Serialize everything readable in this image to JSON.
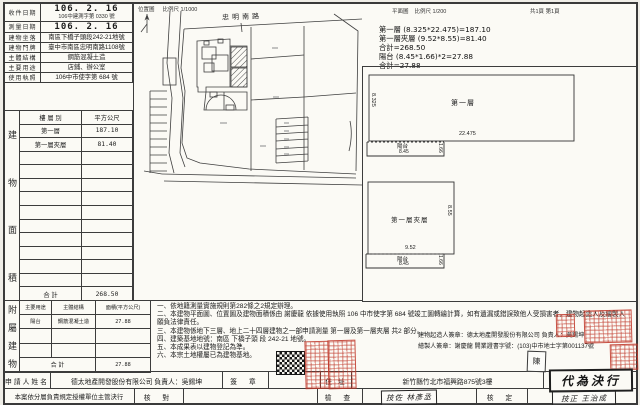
{
  "header": {
    "location_title": "位置圖",
    "location_scale": "比例尺 1/1000",
    "street": "忠明南路",
    "plan_title": "平面圖",
    "plan_scale": "比例尺 1/200",
    "pages": "共1頁 第1頁"
  },
  "info": {
    "rows": [
      {
        "label": "收件日期",
        "value": "106. 2. 16",
        "value2": "106中建測字第 0330 號"
      },
      {
        "label": "測量日期",
        "value": "106. 2. 16",
        "value2": ""
      },
      {
        "label": "建物坐落",
        "value": "南區下橋子頭段242-21地號",
        "value2": ""
      },
      {
        "label": "建物門牌",
        "value": "臺中市南區忠明南路1108號",
        "value2": ""
      },
      {
        "label": "主體結構",
        "value": "鋼筋混凝土造",
        "value2": ""
      },
      {
        "label": "主要用途",
        "value": "店鋪、辦公室",
        "value2": ""
      },
      {
        "label": "使用執照",
        "value": "106中市使字第 684 號",
        "value2": ""
      }
    ]
  },
  "area": {
    "vertical": [
      "建",
      "物",
      "面",
      "積"
    ],
    "col1": "樓 層 別",
    "col2": "平方公尺",
    "rows": [
      [
        "第一層",
        "187.10"
      ],
      [
        "第一層夾層",
        "81.40"
      ]
    ],
    "total_label": "合  計",
    "total_value": "268.50"
  },
  "annex": {
    "vertical": [
      "附",
      "屬",
      "建",
      "物"
    ],
    "col1": "主要用途",
    "col2": "主體結構",
    "col3": "面積(平方公尺)",
    "rows": [
      [
        "陽台",
        "鋼筋混凝土造",
        "27.88"
      ]
    ],
    "total_label": "合  計",
    "total_value": "27.88"
  },
  "calc": {
    "lines": [
      "第一層 (8.325*22.475)=187.10",
      "第一層夾層 (9.52*8.55)=81.40",
      "合計=268.50",
      "陽台 (8.45*1.66)*2=27.88",
      "合計=27.88"
    ]
  },
  "plan": {
    "floor1": "第一層",
    "floor1_h": "8.325",
    "floor1_w": "22.475",
    "balcony1": "陽台",
    "balcony1_w": "8.45",
    "balcony1_d": "1.66",
    "mezz": "第一層夾層",
    "mezz_h": "8.55",
    "mezz_w": "9.52",
    "balcony2": "陽台",
    "balcony2_w": "8.45",
    "balcony2_d": "1.66"
  },
  "notes": {
    "items": [
      "一、依地籍測量實施規則第282條之2規定辦理。",
      "二、本建物平面圖、位置圖及建物面積係由 謝慶龍 依據使用執照 106 中市使字第 684 號竣工圖轉繪計算，如有遺漏或錯誤致他人受損害者，建物起造人及繪製人願負法律責任。",
      "三、本建物係地下三層、地上二十四層建物之一部申請測量 第一層及第一層夾層 共2 部分。",
      "四、建築基地地號：南區 下橋子頭 段 242-21 地號。",
      "五、本成果表以建物登記為準。",
      "六、本宗土地權屬已為建物基地。"
    ]
  },
  "sig": {
    "builder": "建物起造人簽章：德太地產開發股份有限公司 負責人：吳錫坤",
    "drafter": "繪製人簽章：謝慶龍 開業證書字號：(103)中市地士字第001137號",
    "drafter_seal": "陳"
  },
  "bottom": {
    "applicant_label": "申請人姓名",
    "applicant_value": "德太地產開發股份有限公司 負責人：吳錫坤",
    "sign_label": "簽 章",
    "address_label": "住 址",
    "address_value": "新竹縣竹北市福興路875號3樓",
    "delegate_label": "本案依分層負責規定授權單位主管決行",
    "check_label": "核 對",
    "inspect_label": "檢 查",
    "inspector": "技佐 林彥丞",
    "approve_label": "核 定",
    "approver": "技正 王治成",
    "decision": "代為決行"
  },
  "colors": {
    "seal_red": "#c0392b",
    "ink": "#1c1c1c",
    "paper": "#fbfaf5"
  }
}
